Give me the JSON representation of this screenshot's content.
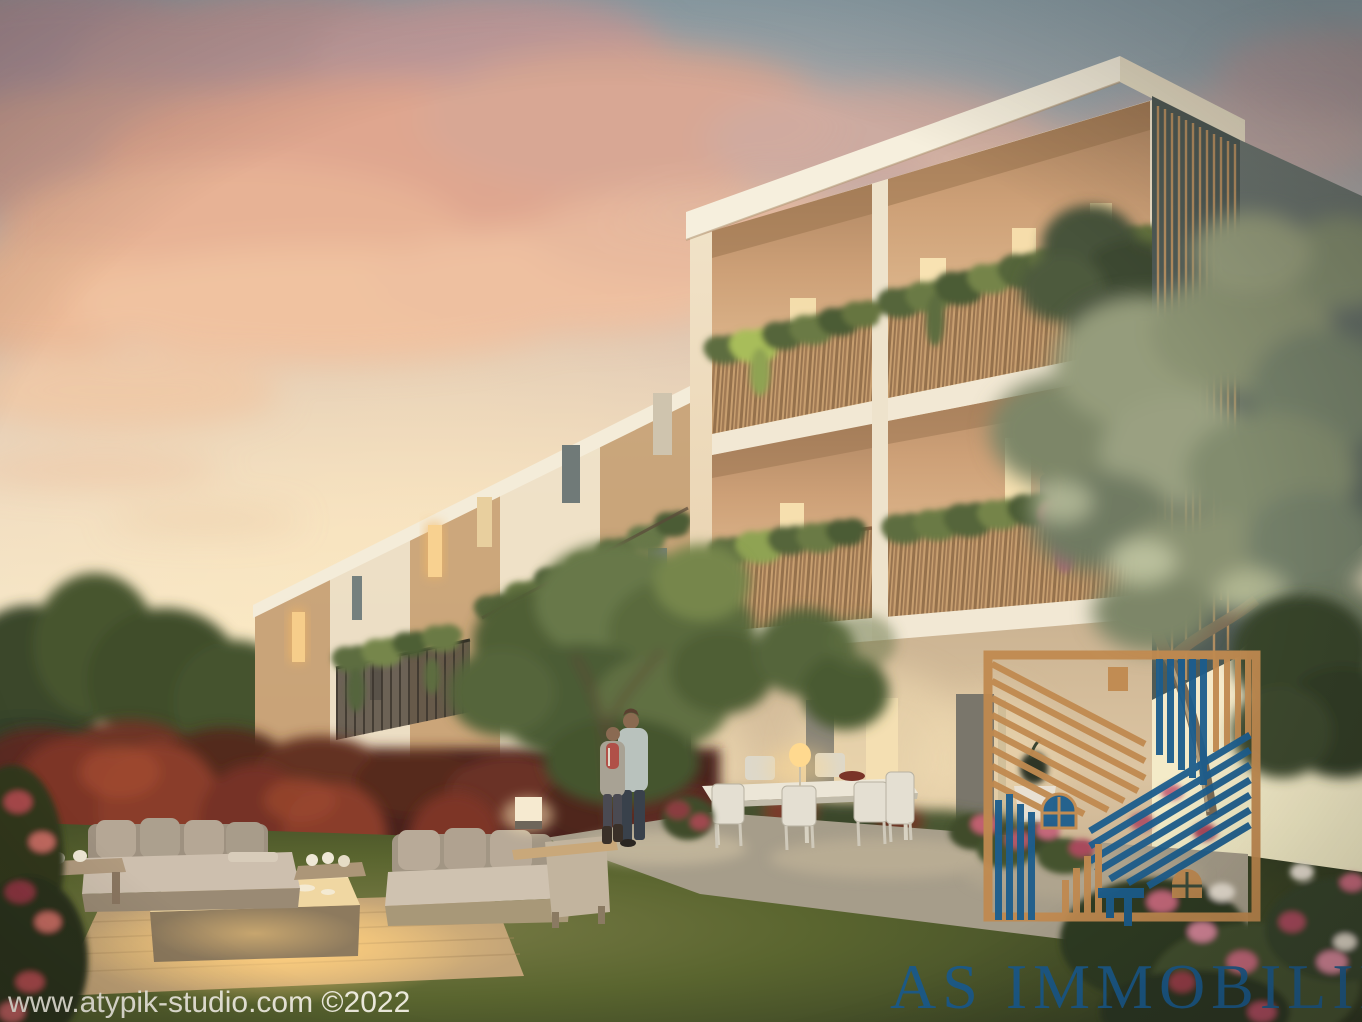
{
  "scene": {
    "kind": "architectural-exterior-render",
    "time": "sunset"
  },
  "watermark": {
    "text": "www.atypik-studio.com ©2022",
    "color": "#f2efe4"
  },
  "brand": {
    "name": "AS IMMOBILIER 7",
    "text_color": "#1a5a8c",
    "logo_gold": "#c08a50",
    "logo_blue": "#1c5d8d"
  },
  "palette": {
    "sky_top": "#93a5ad",
    "sky_warm": "#f6e8cb",
    "cloud_pink": "#dfa68f",
    "facade_cream": "#f0e3cc",
    "facade_tan": "#c39b6e",
    "balcony_wood": "#c69c6d",
    "window_glow": "#f6cd8a",
    "lawn_green": "#5c6b3a",
    "hedge_red": "#6a3226",
    "gravel": "#a69d8a"
  }
}
